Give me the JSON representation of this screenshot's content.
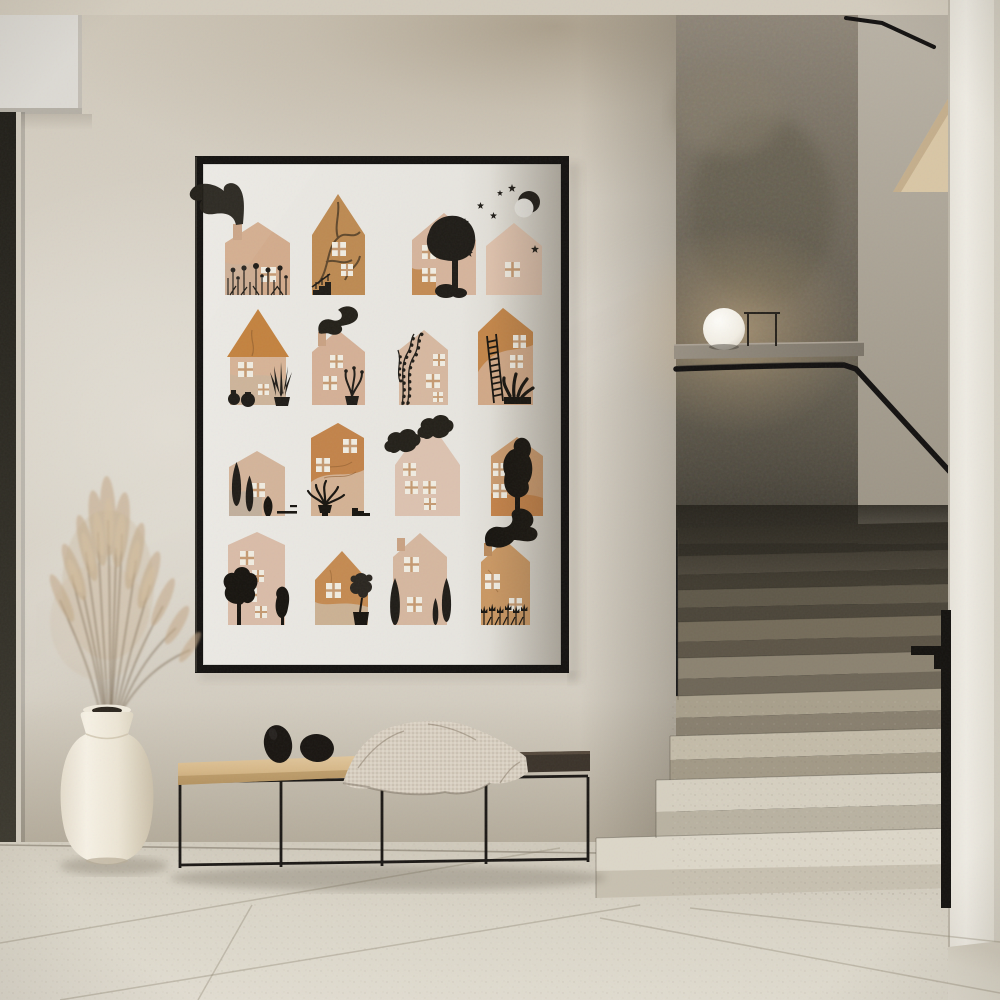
{
  "scene": {
    "kind": "photograph",
    "setting": "minimalist hallway with staircase and framed art print",
    "lighting": "soft daylight from the left",
    "contains_text": false
  },
  "palette": {
    "wall": "#d5cfc3",
    "wall_shadow_top": "#9a8c78",
    "ceiling": "#d3ccbe",
    "doorway_dark": "#2e2c24",
    "stairwell_dark_wall": "#6e675a",
    "right_wall": "#ece9e1",
    "floor": "#ddd8cb",
    "stairs_dark": "#454035",
    "stairs_light": "#dcd6c8",
    "frame_black": "#141210",
    "poster_paper": "#e9e7e1",
    "house_tan": "#d5b49c",
    "house_kraft": "#c08448",
    "ink_black": "#211e1a",
    "bench_wood": "#d9bd92",
    "bench_dark_top": "#3b332a",
    "blanket_knit": "#d7cec0",
    "vase_cream": "#efe9dc",
    "pampas": "#c1a785",
    "lamp_white": "#f6f3ec",
    "metal_black": "#1b1916"
  },
  "poster": {
    "name": "paper collage houses art print, 4 by 4 grid",
    "rows": 4,
    "cols": 4,
    "tiles": [
      {
        "label": "tan house with chimney smoke plume and black wildflower meadow"
      },
      {
        "label": "steep kraft gable house with branch pattern and entry stairs"
      },
      {
        "label": "tan house with large round black tree"
      },
      {
        "label": "night house with crescent moon and scattered stars"
      },
      {
        "label": "tall orange roof house with potted agave and two black jars"
      },
      {
        "label": "house with wavy chimney smoke and potted plant"
      },
      {
        "label": "house with climbing leafy vine"
      },
      {
        "label": "tall two-tone house with ladder and leafy planter"
      },
      {
        "label": "cottage with two cypress trees and black jar"
      },
      {
        "label": "tall orange house with houseplant and side steps"
      },
      {
        "label": "tall pale gable house with two black clouds"
      },
      {
        "label": "house with tall black tree at right"
      },
      {
        "label": "tall house with two round garden trees"
      },
      {
        "label": "orange house with small potted tree"
      },
      {
        "label": "house flanked by cypress trees"
      },
      {
        "label": "house with big chimney smoke and tulip garden"
      }
    ]
  },
  "objects": {
    "poster_frame": {
      "label": "thin black framed art print behind glass"
    },
    "bench": {
      "label": "black metal frame bench with wooden seat and dark tray end"
    },
    "blanket": {
      "label": "knitted beige throw draped over bench"
    },
    "stones": {
      "label": "two black egg-shaped decorative stones"
    },
    "vase": {
      "label": "cream ceramic floor vase"
    },
    "pampas": {
      "label": "dried pampas grass bouquet"
    },
    "lamp": {
      "label": "white globe lamp on concrete ledge"
    },
    "side_table": {
      "label": "thin metal side table silhouette"
    },
    "staircase": {
      "label": "terrazzo staircase fading into shadow"
    },
    "handrail": {
      "label": "black flat-bar handrail"
    },
    "doorway": {
      "label": "dark door opening at far left"
    }
  }
}
